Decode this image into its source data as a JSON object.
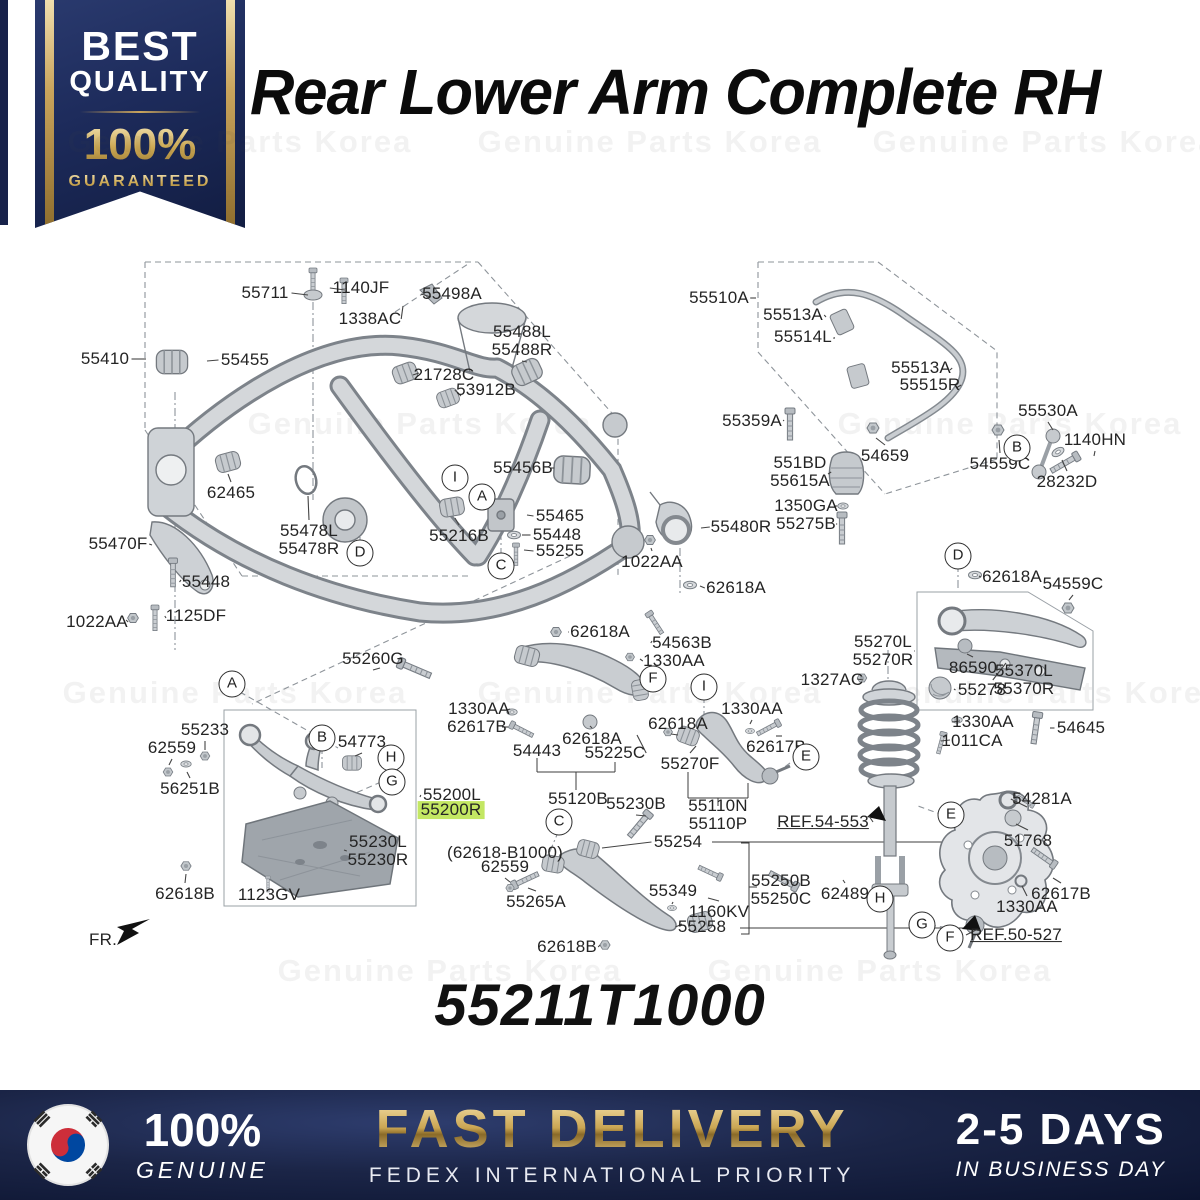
{
  "badge": {
    "line1": "BEST",
    "line2": "QUALITY",
    "percent": "100%",
    "guaranteed": "GUARANTEED"
  },
  "title": "Rear Lower Arm Complete RH",
  "part_number": "55211T1000",
  "watermark_text": "Genuine Parts Korea",
  "colors": {
    "navy": "#18224a",
    "gold": "#c9a45c",
    "highlight": "#c3e763"
  },
  "footer": {
    "flag_icon": "south-korea-flag",
    "genuine_percent": "100%",
    "genuine_label": "GENUINE",
    "fast_delivery": "FAST DELIVERY",
    "courier": "FEDEX INTERNATIONAL PRIORITY",
    "days": "2-5 DAYS",
    "days_sub": "IN BUSINESS DAY"
  },
  "diagram": {
    "watermarks": [
      {
        "x": 240,
        "y": 142
      },
      {
        "x": 650,
        "y": 142
      },
      {
        "x": 1045,
        "y": 142
      },
      {
        "x": 420,
        "y": 424
      },
      {
        "x": 1010,
        "y": 424
      },
      {
        "x": 235,
        "y": 693
      },
      {
        "x": 650,
        "y": 693
      },
      {
        "x": 1050,
        "y": 693
      },
      {
        "x": 450,
        "y": 971
      },
      {
        "x": 880,
        "y": 971
      }
    ],
    "labels": [
      {
        "text": "55711",
        "x": 265,
        "y": 293,
        "tx": 308,
        "ty": 295
      },
      {
        "text": "1140JF",
        "x": 361,
        "y": 288,
        "tx": 345,
        "ty": 290
      },
      {
        "text": "55498A",
        "x": 452,
        "y": 294,
        "tx": 431,
        "ty": 297
      },
      {
        "text": "1338AC",
        "x": 370,
        "y": 319,
        "tx": 403,
        "ty": 306
      },
      {
        "text": "55410",
        "x": 105,
        "y": 359,
        "tx": 146,
        "ty": 359
      },
      {
        "text": "55455",
        "x": 245,
        "y": 360,
        "tx": 207,
        "ty": 361
      },
      {
        "text": "21728C",
        "x": 444,
        "y": 375,
        "tx": 419,
        "ty": 373
      },
      {
        "text": "53912B",
        "x": 486,
        "y": 390,
        "tx": 461,
        "ty": 396
      },
      {
        "text": "55488L\n55488R",
        "x": 522,
        "y": 341,
        "tx": 527,
        "ty": 362
      },
      {
        "text": "62465",
        "x": 231,
        "y": 493,
        "tx": 228,
        "ty": 474
      },
      {
        "text": "55456B",
        "x": 523,
        "y": 468,
        "tx": 551,
        "ty": 468
      },
      {
        "text": "55478L\n55478R",
        "x": 309,
        "y": 540,
        "tx": 308,
        "ty": 496
      },
      {
        "text": "55216B",
        "x": 459,
        "y": 536,
        "tx": 455,
        "ty": 518
      },
      {
        "text": "55465",
        "x": 560,
        "y": 516,
        "tx": 527,
        "ty": 515
      },
      {
        "text": "55448",
        "x": 557,
        "y": 535,
        "tx": 522,
        "ty": 535
      },
      {
        "text": "55255",
        "x": 560,
        "y": 551,
        "tx": 524,
        "ty": 550
      },
      {
        "text": "55470F",
        "x": 118,
        "y": 544,
        "tx": 152,
        "ty": 545
      },
      {
        "text": "55448",
        "x": 206,
        "y": 582,
        "tx": 181,
        "ty": 580
      },
      {
        "text": "1022AA",
        "x": 97,
        "y": 622,
        "tx": 126,
        "ty": 620
      },
      {
        "text": "1125DF",
        "x": 196,
        "y": 616,
        "tx": 166,
        "ty": 618
      },
      {
        "text": "1022AA",
        "x": 652,
        "y": 562,
        "tx": 651,
        "ty": 548
      },
      {
        "text": "55480R",
        "x": 741,
        "y": 527,
        "tx": 701,
        "ty": 528
      },
      {
        "text": "62618A",
        "x": 736,
        "y": 588,
        "tx": 700,
        "ty": 586
      },
      {
        "text": "55510A",
        "x": 719,
        "y": 298,
        "tx": 756,
        "ty": 298
      },
      {
        "text": "55513A",
        "x": 793,
        "y": 315,
        "tx": 826,
        "ty": 317
      },
      {
        "text": "55514L",
        "x": 803,
        "y": 337,
        "tx": 834,
        "ty": 339
      },
      {
        "text": "55513A",
        "x": 921,
        "y": 368,
        "tx": 950,
        "ty": 370
      },
      {
        "text": "55515R",
        "x": 930,
        "y": 385,
        "tx": 956,
        "ty": 388
      },
      {
        "text": "55359A",
        "x": 752,
        "y": 421,
        "tx": 784,
        "ty": 420
      },
      {
        "text": "54659",
        "x": 885,
        "y": 456,
        "tx": 876,
        "ty": 438
      },
      {
        "text": "54559C",
        "x": 1000,
        "y": 464,
        "tx": 999,
        "ty": 440
      },
      {
        "text": "1140HN",
        "x": 1095,
        "y": 440,
        "tx": 1094,
        "ty": 456
      },
      {
        "text": "28232D",
        "x": 1067,
        "y": 482,
        "tx": 1062,
        "ty": 460
      },
      {
        "text": "55530A",
        "x": 1048,
        "y": 411,
        "tx": 1053,
        "ty": 430
      },
      {
        "text": "551BD\n55615A",
        "x": 800,
        "y": 472,
        "tx": 828,
        "ty": 474
      },
      {
        "text": "1350GA",
        "x": 806,
        "y": 506,
        "tx": 835,
        "ty": 506
      },
      {
        "text": "55275B",
        "x": 806,
        "y": 524,
        "tx": 836,
        "ty": 524
      },
      {
        "text": "62618A",
        "x": 1012,
        "y": 577,
        "tx": 979,
        "ty": 576
      },
      {
        "text": "54559C",
        "x": 1073,
        "y": 584,
        "tx": 1069,
        "ty": 600
      },
      {
        "text": "55270L\n55270R",
        "x": 883,
        "y": 651,
        "tx": 915,
        "ty": 651
      },
      {
        "text": "86590",
        "x": 973,
        "y": 668,
        "tx": 967,
        "ty": 654
      },
      {
        "text": "55370L\n55370R",
        "x": 1024,
        "y": 680,
        "tx": 1006,
        "ty": 663
      },
      {
        "text": "55278",
        "x": 982,
        "y": 690,
        "tx": 954,
        "ty": 689
      },
      {
        "text": "1327AC",
        "x": 832,
        "y": 680,
        "tx": 857,
        "ty": 679
      },
      {
        "text": "1330AA",
        "x": 983,
        "y": 722,
        "tx": 960,
        "ty": 721
      },
      {
        "text": "1011CA",
        "x": 972,
        "y": 741,
        "tx": 950,
        "ty": 740
      },
      {
        "text": "54645",
        "x": 1081,
        "y": 728,
        "tx": 1050,
        "ty": 728
      },
      {
        "text": "62618A",
        "x": 600,
        "y": 632,
        "tx": 568,
        "ty": 632
      },
      {
        "text": "54563B",
        "x": 682,
        "y": 643,
        "tx": 652,
        "ty": 641
      },
      {
        "text": "1330AA",
        "x": 674,
        "y": 661,
        "tx": 640,
        "ty": 659
      },
      {
        "text": "1330AA",
        "x": 479,
        "y": 709,
        "tx": 506,
        "ty": 710
      },
      {
        "text": "62617B",
        "x": 477,
        "y": 727,
        "tx": 502,
        "ty": 727
      },
      {
        "text": "54443",
        "x": 537,
        "y": 751
      },
      {
        "text": "62618A",
        "x": 592,
        "y": 739,
        "tx": 590,
        "ty": 726
      },
      {
        "text": "55225C",
        "x": 615,
        "y": 753,
        "tx": 637,
        "ty": 735
      },
      {
        "text": "62618A",
        "x": 678,
        "y": 724,
        "tx": 671,
        "ty": 734
      },
      {
        "text": "1330AA",
        "x": 752,
        "y": 709,
        "tx": 750,
        "ty": 724
      },
      {
        "text": "62617B",
        "x": 776,
        "y": 747,
        "tx": 782,
        "ty": 736
      },
      {
        "text": "55270F",
        "x": 690,
        "y": 764,
        "tx": 696,
        "ty": 746
      },
      {
        "text": "55110N\n55110P",
        "x": 718,
        "y": 815
      },
      {
        "text": "REF.54-553",
        "x": 823,
        "y": 822,
        "tx": 869,
        "ty": 816,
        "underline": true
      },
      {
        "text": "55260G",
        "x": 373,
        "y": 659,
        "tx": 380,
        "ty": 668
      },
      {
        "text": "55233",
        "x": 205,
        "y": 730,
        "tx": 205,
        "ty": 750
      },
      {
        "text": "62559",
        "x": 172,
        "y": 748,
        "tx": 169,
        "ty": 765
      },
      {
        "text": "54773",
        "x": 362,
        "y": 742,
        "tx": 355,
        "ty": 756
      },
      {
        "text": "56251B",
        "x": 190,
        "y": 789,
        "tx": 187,
        "ty": 772
      },
      {
        "text": "55200L",
        "x": 452,
        "y": 795,
        "tx": 420,
        "ty": 797
      },
      {
        "text": "55200R",
        "x": 451,
        "y": 810,
        "highlight": true
      },
      {
        "text": "55230L\n55230R",
        "x": 378,
        "y": 851,
        "tx": 344,
        "ty": 850
      },
      {
        "text": "62618B",
        "x": 185,
        "y": 894,
        "tx": 186,
        "ty": 874
      },
      {
        "text": "1123GV",
        "x": 269,
        "y": 895,
        "tx": 269,
        "ty": 884
      },
      {
        "text": "55120B",
        "x": 578,
        "y": 799
      },
      {
        "text": "55230B",
        "x": 636,
        "y": 804,
        "tx": 646,
        "ty": 816
      },
      {
        "text": "(62618-B1000)",
        "x": 505,
        "y": 853
      },
      {
        "text": "62559",
        "x": 505,
        "y": 867,
        "tx": 510,
        "ty": 882
      },
      {
        "text": "55265A",
        "x": 536,
        "y": 902,
        "tx": 528,
        "ty": 888
      },
      {
        "text": "55254",
        "x": 678,
        "y": 842,
        "tx": 602,
        "ty": 848
      },
      {
        "text": "55349",
        "x": 673,
        "y": 891,
        "tx": 672,
        "ty": 904
      },
      {
        "text": "1160KV",
        "x": 719,
        "y": 912,
        "tx": 708,
        "ty": 898
      },
      {
        "text": "55258",
        "x": 702,
        "y": 927,
        "tx": 682,
        "ty": 924
      },
      {
        "text": "62618B",
        "x": 567,
        "y": 947,
        "tx": 600,
        "ty": 945
      },
      {
        "text": "55250B\n55250C",
        "x": 781,
        "y": 890
      },
      {
        "text": "62489",
        "x": 845,
        "y": 894,
        "tx": 843,
        "ty": 880
      },
      {
        "text": "54281A",
        "x": 1042,
        "y": 799,
        "tx": 1027,
        "ty": 807
      },
      {
        "text": "51768",
        "x": 1028,
        "y": 841,
        "tx": 1016,
        "ty": 824
      },
      {
        "text": "62617B",
        "x": 1061,
        "y": 894,
        "tx": 1053,
        "ty": 878
      },
      {
        "text": "1330AA",
        "x": 1027,
        "y": 907,
        "tx": 1022,
        "ty": 886
      },
      {
        "text": "REF.50-527",
        "x": 1016,
        "y": 935,
        "tx": 978,
        "ty": 929,
        "underline": true
      },
      {
        "text": "FR.",
        "x": 103,
        "y": 940
      }
    ],
    "callouts": [
      {
        "letter": "I",
        "x": 455,
        "y": 478
      },
      {
        "letter": "A",
        "x": 482,
        "y": 497
      },
      {
        "letter": "C",
        "x": 501,
        "y": 566
      },
      {
        "letter": "D",
        "x": 360,
        "y": 553
      },
      {
        "letter": "B",
        "x": 1017,
        "y": 448
      },
      {
        "letter": "D",
        "x": 958,
        "y": 556
      },
      {
        "letter": "F",
        "x": 653,
        "y": 679
      },
      {
        "letter": "I",
        "x": 704,
        "y": 687
      },
      {
        "letter": "E",
        "x": 806,
        "y": 757
      },
      {
        "letter": "A",
        "x": 232,
        "y": 684
      },
      {
        "letter": "B",
        "x": 322,
        "y": 738
      },
      {
        "letter": "H",
        "x": 391,
        "y": 758
      },
      {
        "letter": "G",
        "x": 392,
        "y": 782
      },
      {
        "letter": "C",
        "x": 559,
        "y": 822
      },
      {
        "letter": "E",
        "x": 951,
        "y": 815
      },
      {
        "letter": "H",
        "x": 880,
        "y": 899
      },
      {
        "letter": "G",
        "x": 922,
        "y": 925
      },
      {
        "letter": "F",
        "x": 950,
        "y": 938
      }
    ]
  }
}
